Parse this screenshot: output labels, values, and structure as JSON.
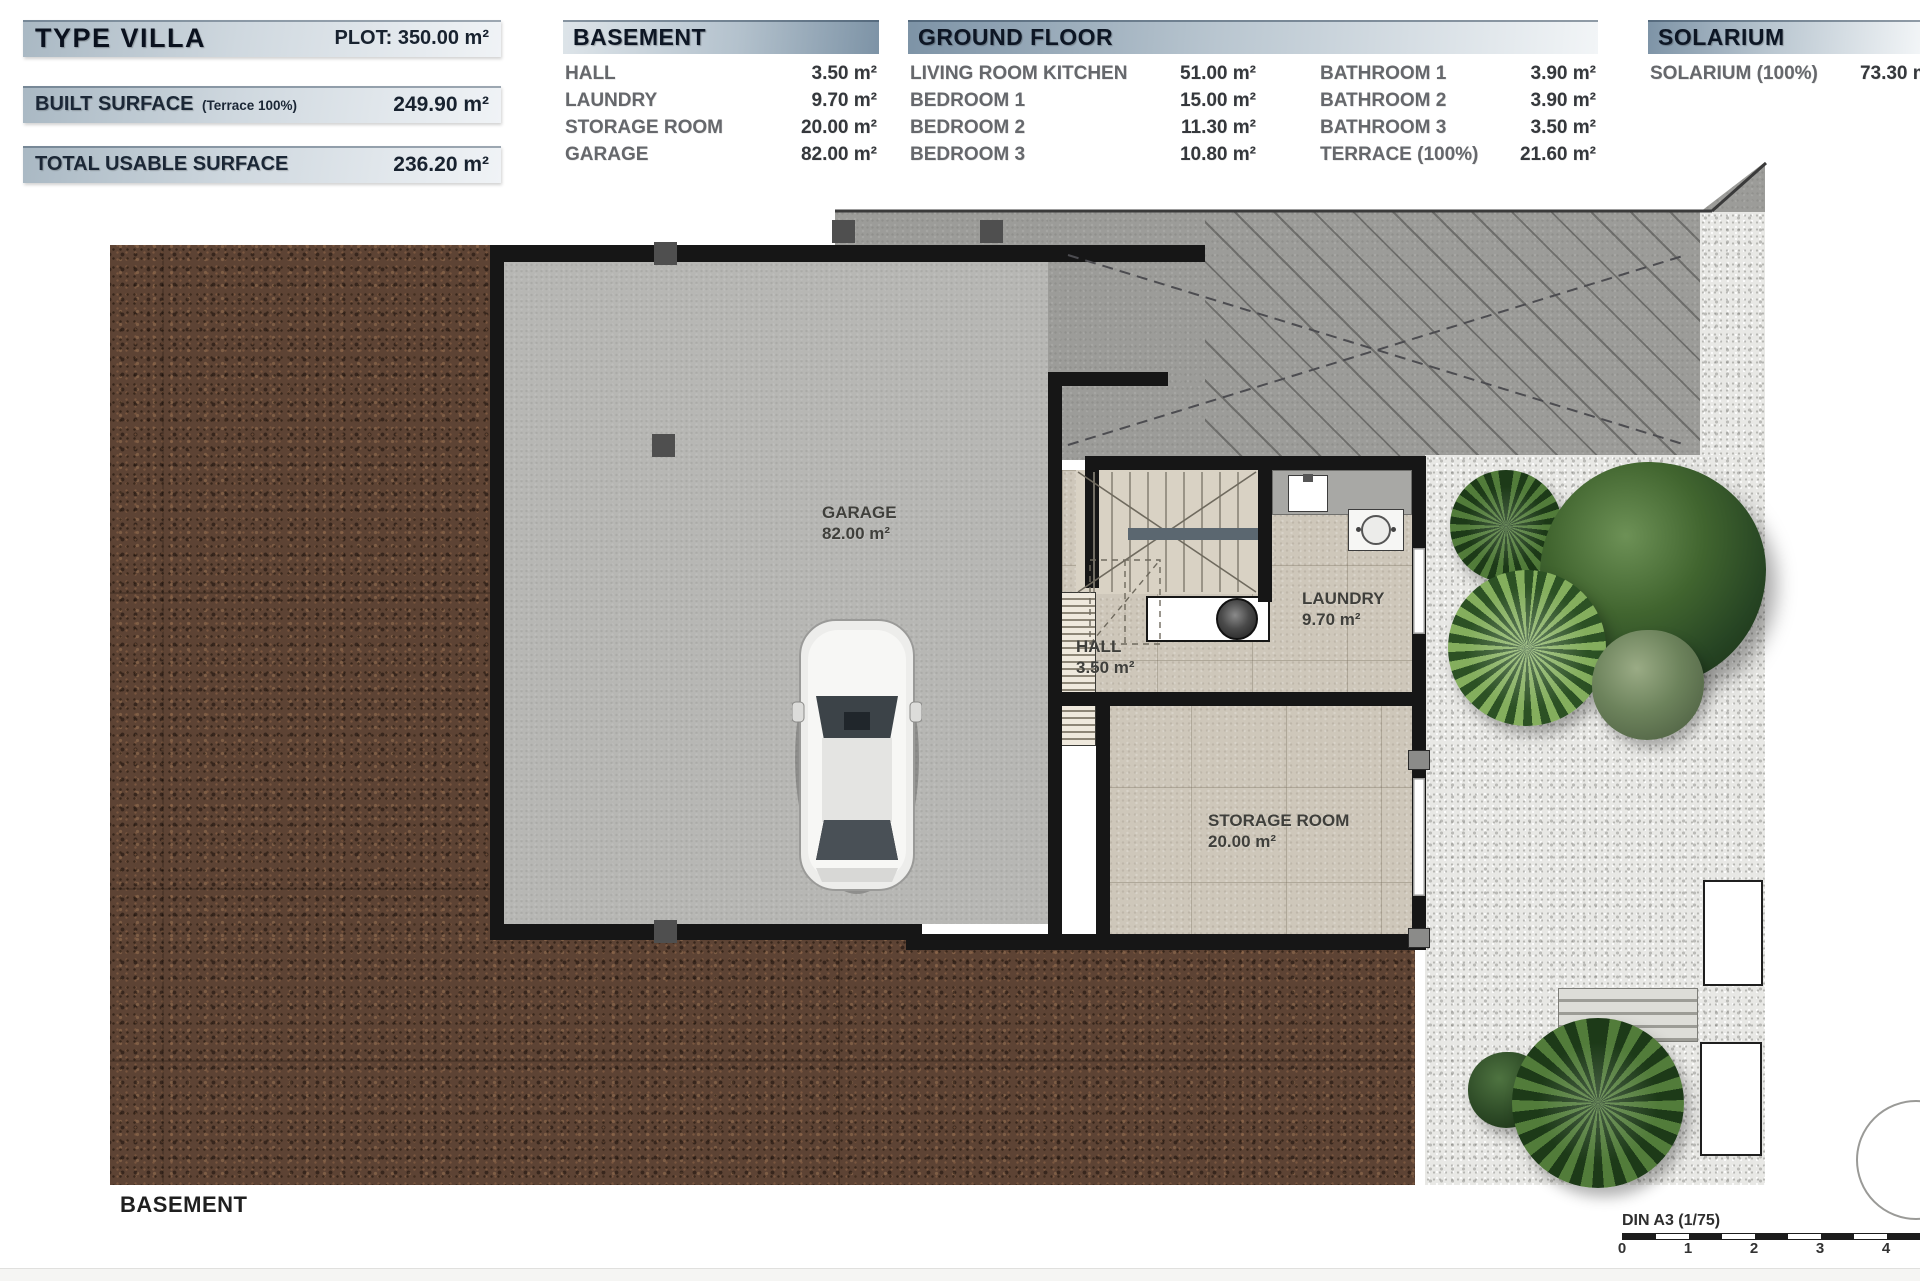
{
  "summary": {
    "type_title": "TYPE VILLA",
    "plot": "PLOT: 350.00 m²",
    "built_label": "BUILT SURFACE",
    "built_note": "(Terrace 100%)",
    "built_value": "249.90 m²",
    "usable_label": "TOTAL USABLE SURFACE",
    "usable_value": "236.20 m²"
  },
  "basement_table": {
    "title": "BASEMENT",
    "rows": [
      {
        "label": "HALL",
        "value": "3.50 m²"
      },
      {
        "label": "LAUNDRY",
        "value": "9.70 m²"
      },
      {
        "label": "STORAGE ROOM",
        "value": "20.00 m²"
      },
      {
        "label": "GARAGE",
        "value": "82.00 m²"
      }
    ]
  },
  "ground_floor_table": {
    "title": "GROUND FLOOR",
    "col1": [
      {
        "label": "LIVING ROOM KITCHEN",
        "value": "51.00 m²"
      },
      {
        "label": "BEDROOM 1",
        "value": "15.00 m²"
      },
      {
        "label": "BEDROOM 2",
        "value": "11.30 m²"
      },
      {
        "label": "BEDROOM 3",
        "value": "10.80 m²"
      }
    ],
    "col2": [
      {
        "label": "BATHROOM 1",
        "value": "3.90 m²"
      },
      {
        "label": "BATHROOM 2",
        "value": "3.90 m²"
      },
      {
        "label": "BATHROOM 3",
        "value": "3.50 m²"
      },
      {
        "label": "TERRACE (100%)",
        "value": "21.60 m²"
      }
    ]
  },
  "solarium_table": {
    "title": "SOLARIUM",
    "rows": [
      {
        "label": "SOLARIUM (100%)",
        "value": "73.30 m²"
      }
    ]
  },
  "plan": {
    "floor_label": "BASEMENT",
    "rooms": {
      "garage": {
        "name": "GARAGE",
        "area": "82.00 m²"
      },
      "hall": {
        "name": "HALL",
        "area": "3.50 m²"
      },
      "laundry": {
        "name": "LAUNDRY",
        "area": "9.70 m²"
      },
      "storage": {
        "name": "STORAGE ROOM",
        "area": "20.00 m²"
      }
    }
  },
  "scale_bar": {
    "label": "DIN A3 (1/75)",
    "ticks": [
      "0",
      "1",
      "2",
      "3",
      "4"
    ]
  },
  "colors": {
    "header_steel_blue": "#7d93a6",
    "header_text": "#0d1624",
    "dirt_brown": "#5d4334",
    "garage_concrete": "#b7b7b4",
    "driveway_gray": "#9c9c99",
    "gravel_white": "#e8e8e5",
    "tile_beige": "#cec7ba",
    "wall_black": "#161616"
  }
}
